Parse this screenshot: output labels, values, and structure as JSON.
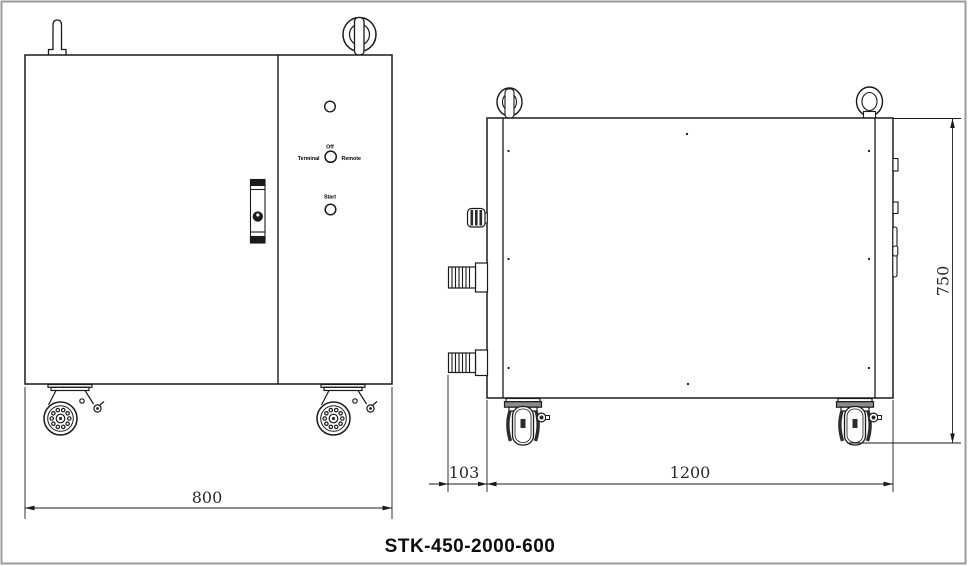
{
  "page": {
    "background": "#ffffff",
    "frame_color": "#9b9b9b"
  },
  "drawing": {
    "title": "STK-450-2000-600",
    "front_view": {
      "control_panel": {
        "selector_top_label": "Off",
        "selector_left_label": "Terminal",
        "selector_right_label": "Remote",
        "start_label": "Start"
      },
      "dimensions": {
        "width": "800"
      }
    },
    "side_view": {
      "dimensions": {
        "fitting_offset": "103",
        "depth": "1200",
        "height": "750"
      }
    },
    "colors": {
      "line": "#1a1a1a",
      "dimension_text": "#2a2a33"
    }
  }
}
